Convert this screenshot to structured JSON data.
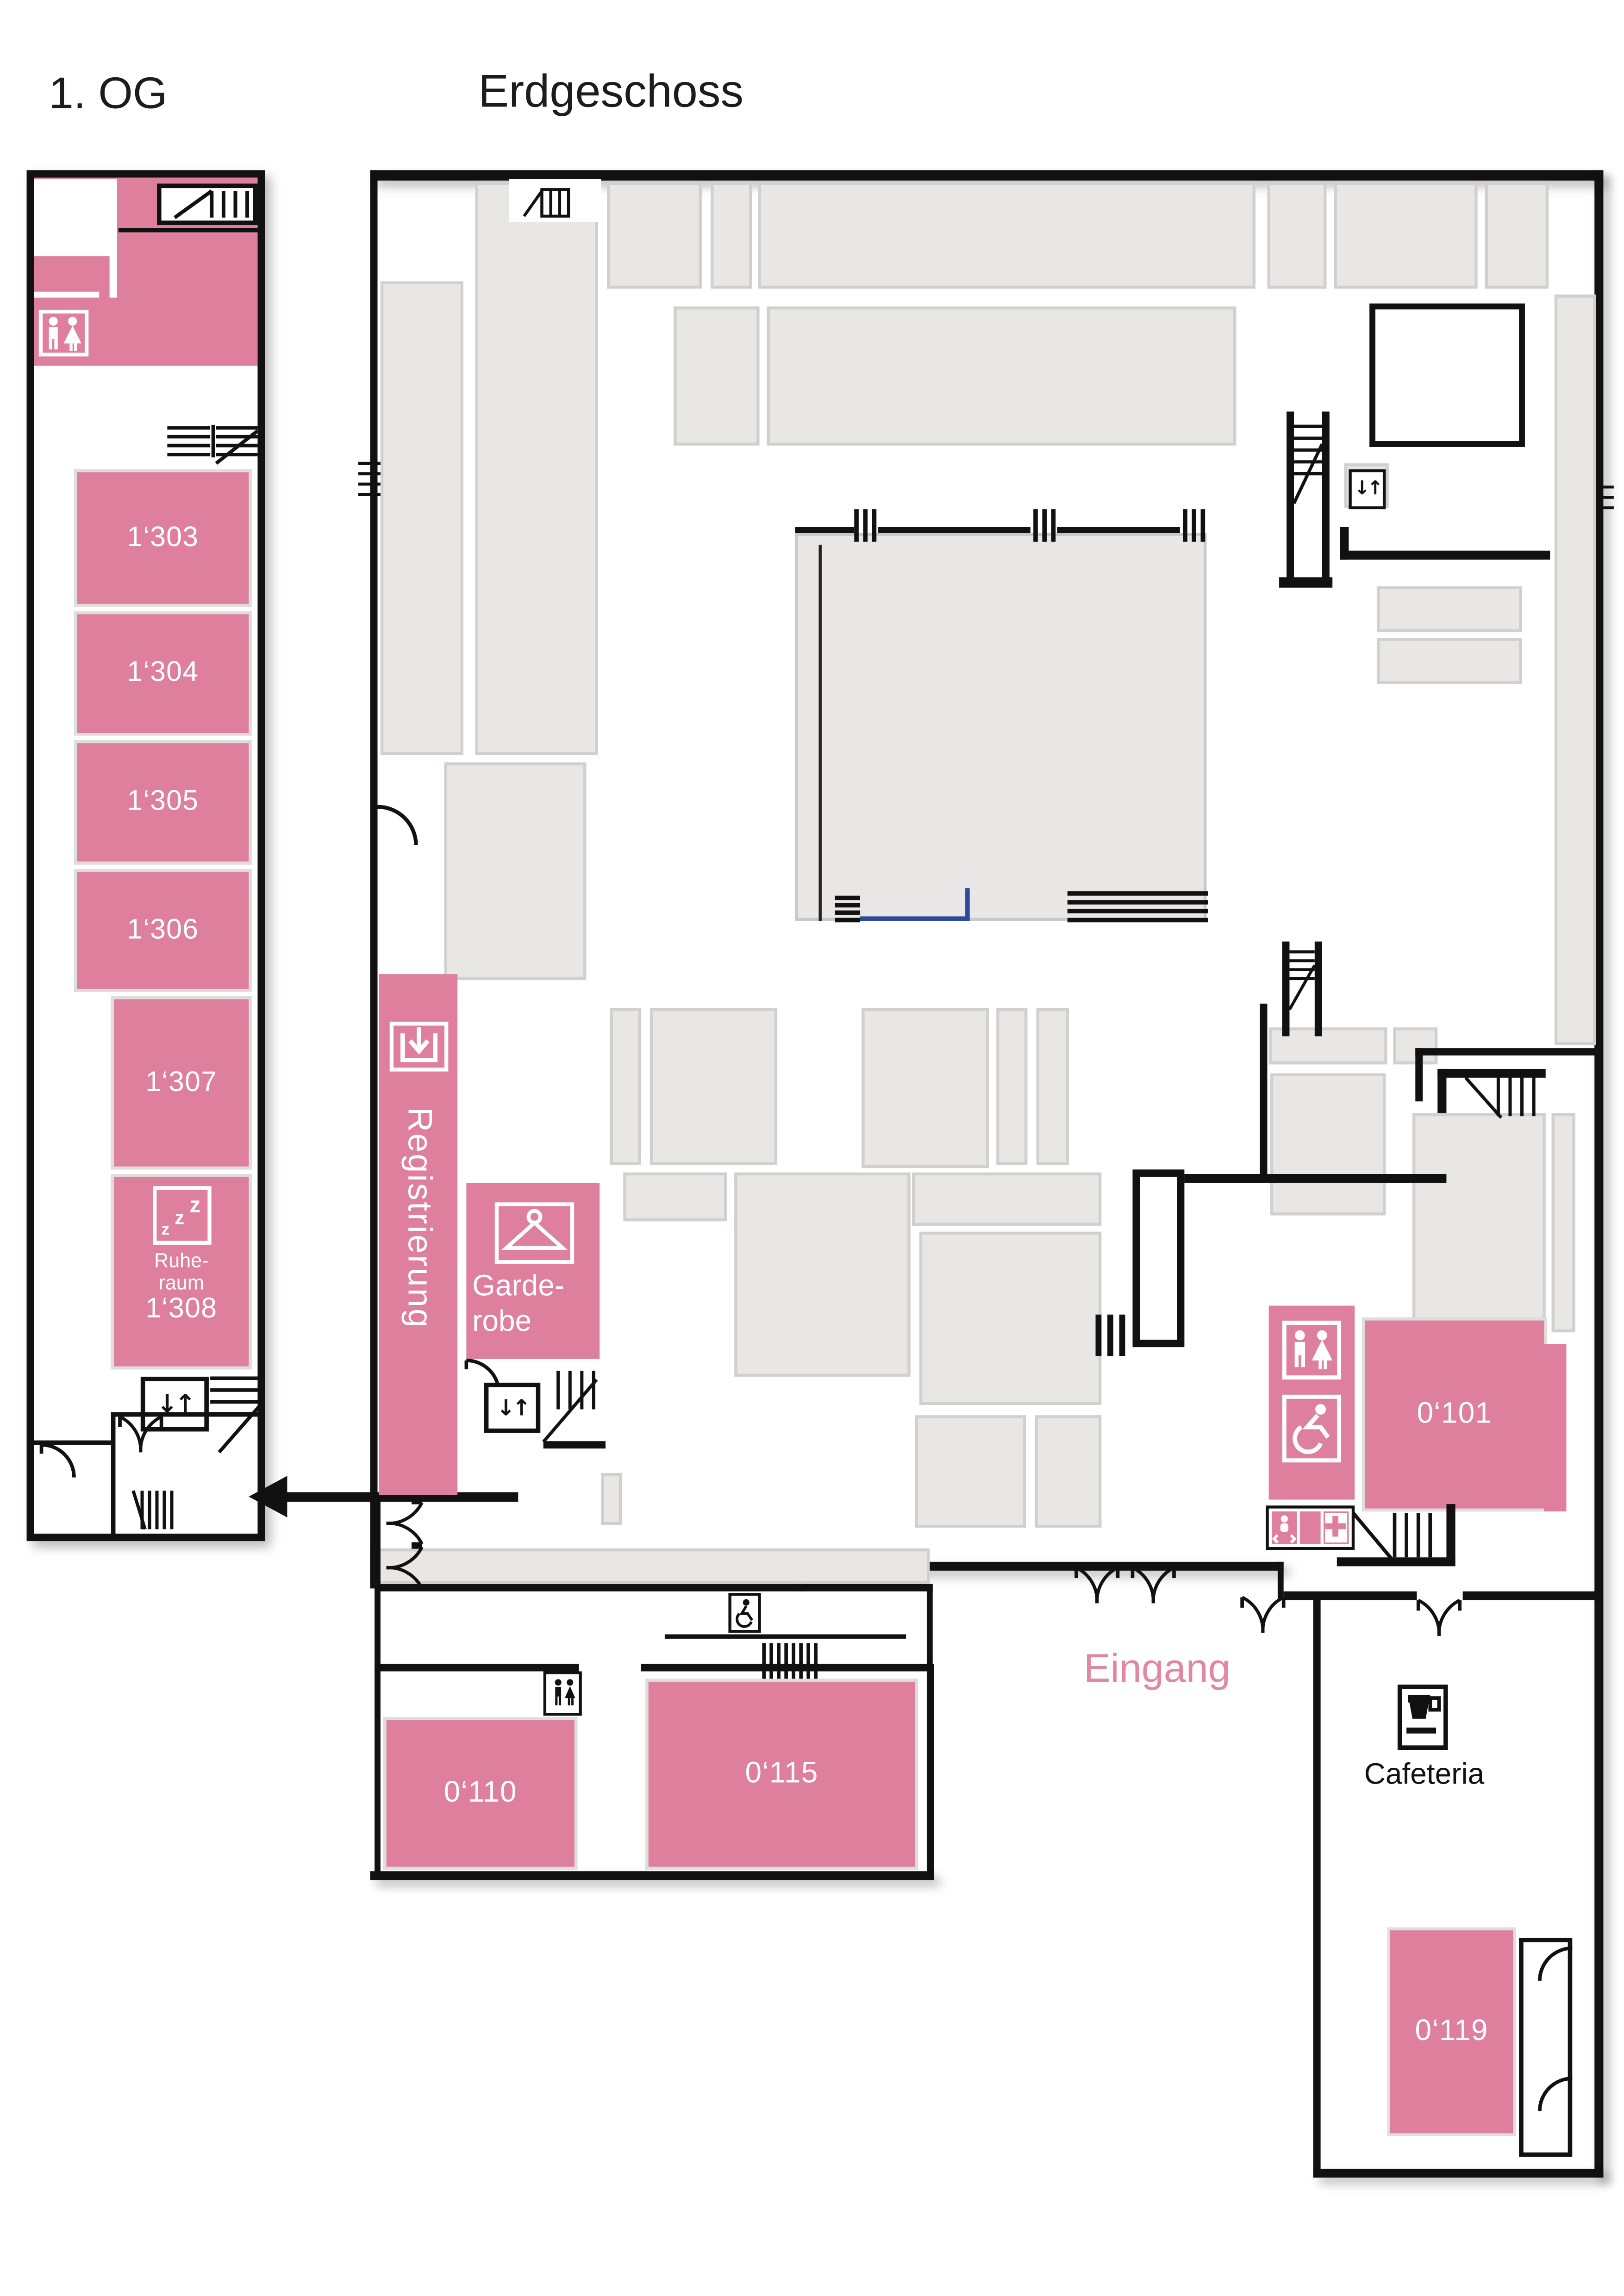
{
  "titles": {
    "first_floor": "1. OG",
    "ground_floor": "Erdgeschoss"
  },
  "colors": {
    "room_pink": "#dd7f9d",
    "booth_gray": "#e8e7e5",
    "wall_black": "#111111",
    "marker_blue": "#2b4a9e",
    "eingang_pink": "#e088a2",
    "label_white": "#ffffff"
  },
  "first_floor": {
    "rooms": [
      {
        "label": "1‘303"
      },
      {
        "label": "1‘304"
      },
      {
        "label": "1‘305"
      },
      {
        "label": "1‘306"
      },
      {
        "label": "1‘307"
      }
    ],
    "ruheraum": {
      "line1": "Ruhe-",
      "line2": "raum",
      "number": "1‘308"
    }
  },
  "ground_floor": {
    "registration_label": "Registrierung",
    "garderobe_line1": "Garde-",
    "garderobe_line2": "robe",
    "eingang_label": "Eingang",
    "cafeteria_label": "Cafeteria",
    "rooms": [
      {
        "label": "0‘101"
      },
      {
        "label": "0‘110"
      },
      {
        "label": "0‘115"
      },
      {
        "label": "0‘119"
      }
    ]
  },
  "icons": {
    "elevator_glyph": "↓↑",
    "z": "z"
  }
}
